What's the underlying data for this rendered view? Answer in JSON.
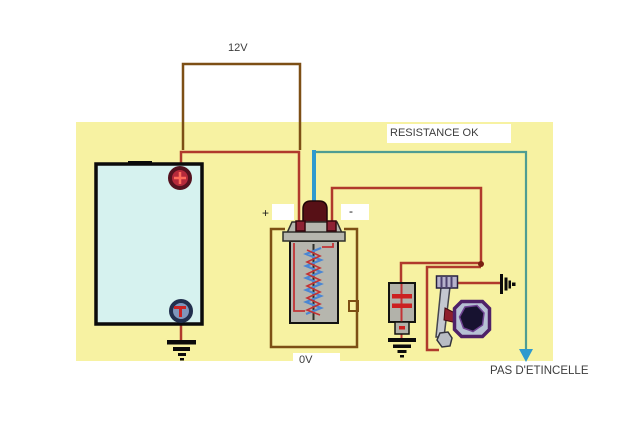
{
  "diagram": {
    "type": "ignition-circuit-test-diagram",
    "labels": {
      "supply_voltage": "12V",
      "resistance_status": "RESISTANCE OK",
      "coil_positive": "+",
      "coil_negative": "-",
      "coil_voltage": "0V",
      "spark_result": "PAS D'ETINCELLE"
    },
    "components": [
      "battery",
      "battery-positive-terminal",
      "battery-negative-terminal",
      "ground-battery",
      "ignition-coil",
      "high-tension-lead",
      "condenser",
      "ground-condenser",
      "breaker-points",
      "distributor-cam",
      "spark-gap",
      "no-spark-arrow"
    ],
    "colors": {
      "background": "#ffffff",
      "panel_yellow": "#f7f2a2",
      "wire_red": "#b03a2c",
      "meter_loop_brown": "#7d4f15",
      "ht_lead_blue": "#2f9ace",
      "spark_path_teal": "#4f9d92",
      "battery_fill": "#d6f2ef",
      "coil_body_gray": "#b6b6ae",
      "cam_purple": "#4e2168",
      "label_text": "#3d3d3d"
    }
  }
}
